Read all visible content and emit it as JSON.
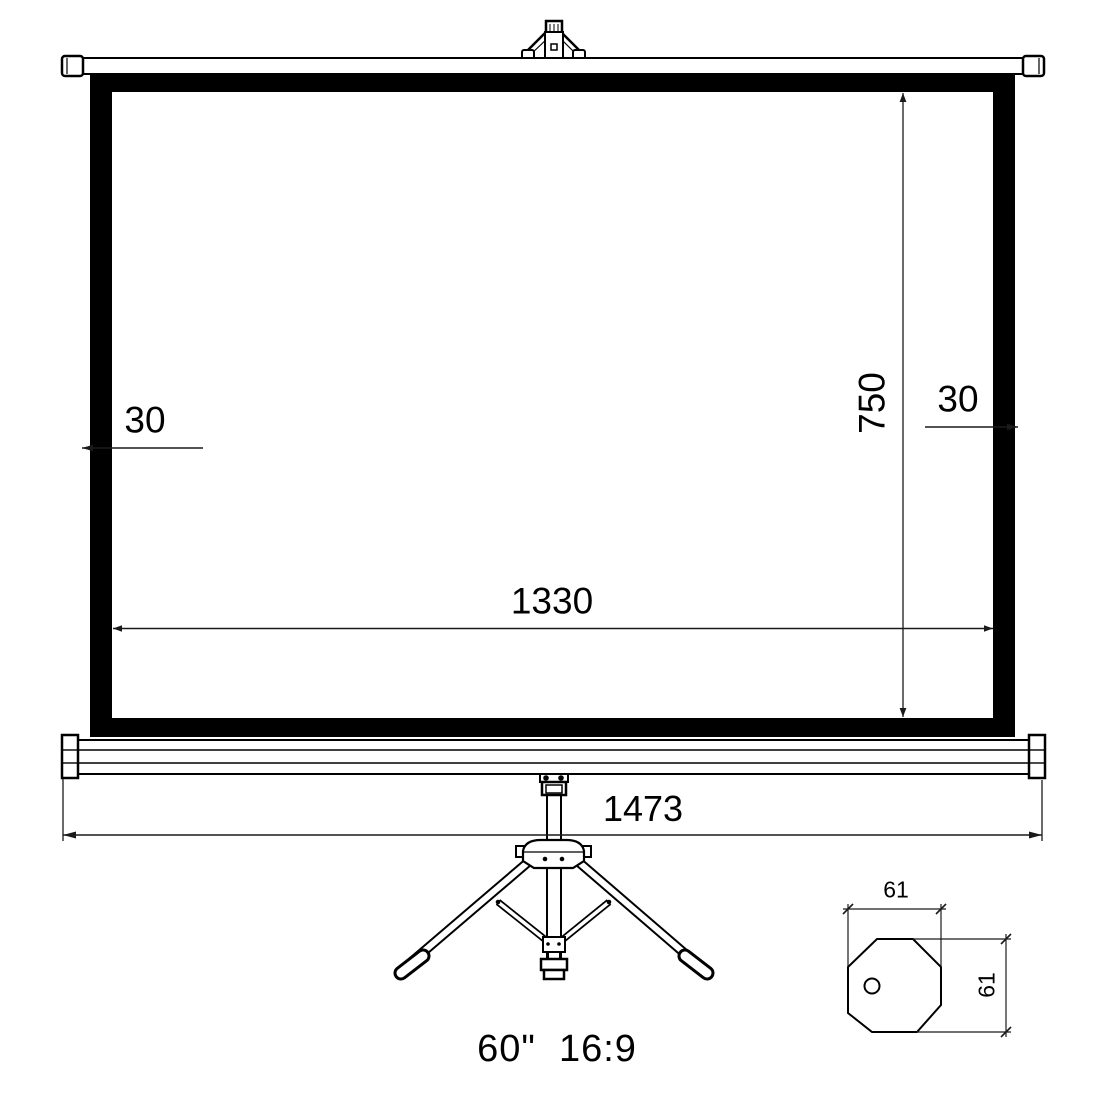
{
  "diagram": {
    "caption": "60\"  16:9",
    "dimensions": {
      "left_border_width_mm": "30",
      "right_border_width_mm": "30",
      "viewing_height_mm": "750",
      "viewing_width_mm": "1330",
      "overall_width_mm": "1473",
      "leg_section_width_mm": "61",
      "leg_section_height_mm": "61"
    },
    "colors": {
      "line": "#000000",
      "background": "#ffffff",
      "frame_fill": "#000000"
    }
  }
}
